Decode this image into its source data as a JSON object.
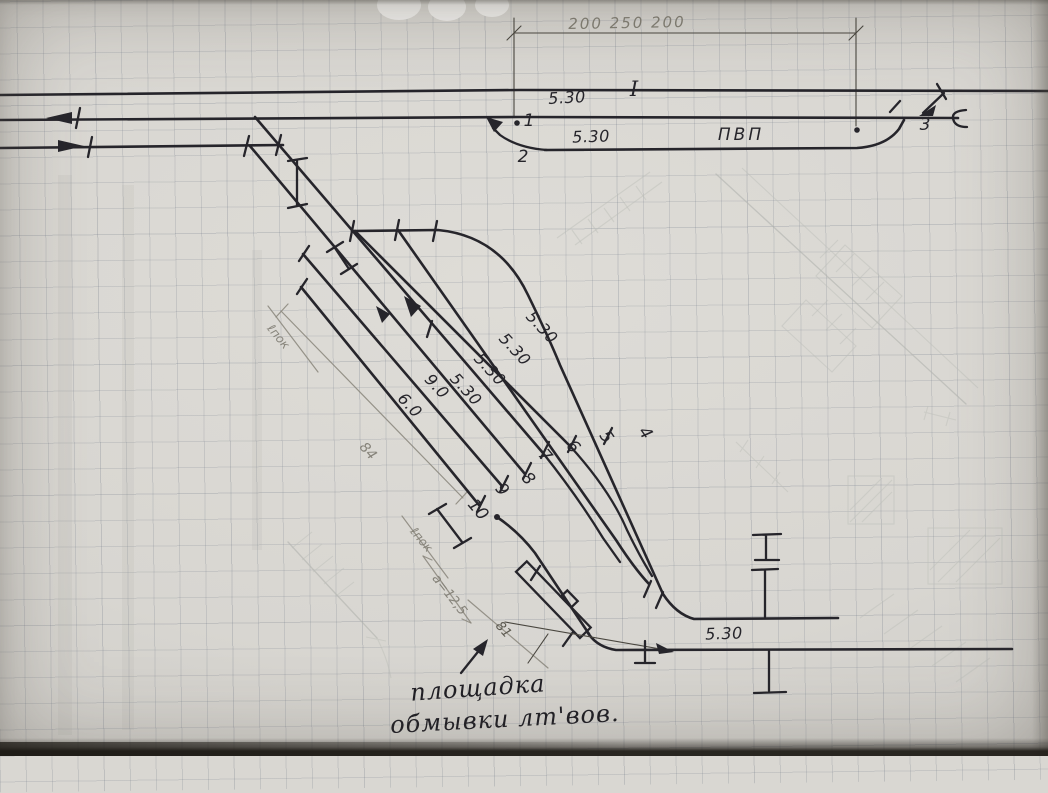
{
  "drawing": {
    "kind": "hand-drawn railway station track scheme on graph paper",
    "colors": {
      "paper": "#d9d7d2",
      "ink": "#26252b",
      "pencil": "#8d8a81",
      "grid": "#6c7584"
    }
  },
  "top": {
    "dimension": "200 250 200",
    "main_track": "I",
    "pvp": "ПВП",
    "spacing": [
      "5.30",
      "5.30"
    ],
    "switches": [
      "1",
      "2",
      "3"
    ]
  },
  "yard": {
    "numbers": [
      "4",
      "5",
      "6",
      "7",
      "8",
      "9",
      "10"
    ],
    "spacing": [
      "5.30",
      "5.30",
      "5.30",
      "5.30",
      "9.0",
      "6.0"
    ],
    "pencil": {
      "dim84": "84",
      "lpok1": "ℓпок",
      "lpok2": "ℓпок",
      "a": "a=12,5",
      "d81": "81"
    }
  },
  "bottom": {
    "spacing": "5.30"
  },
  "caption": {
    "line1": "площадка",
    "line2": "обмывки лт'вов."
  }
}
